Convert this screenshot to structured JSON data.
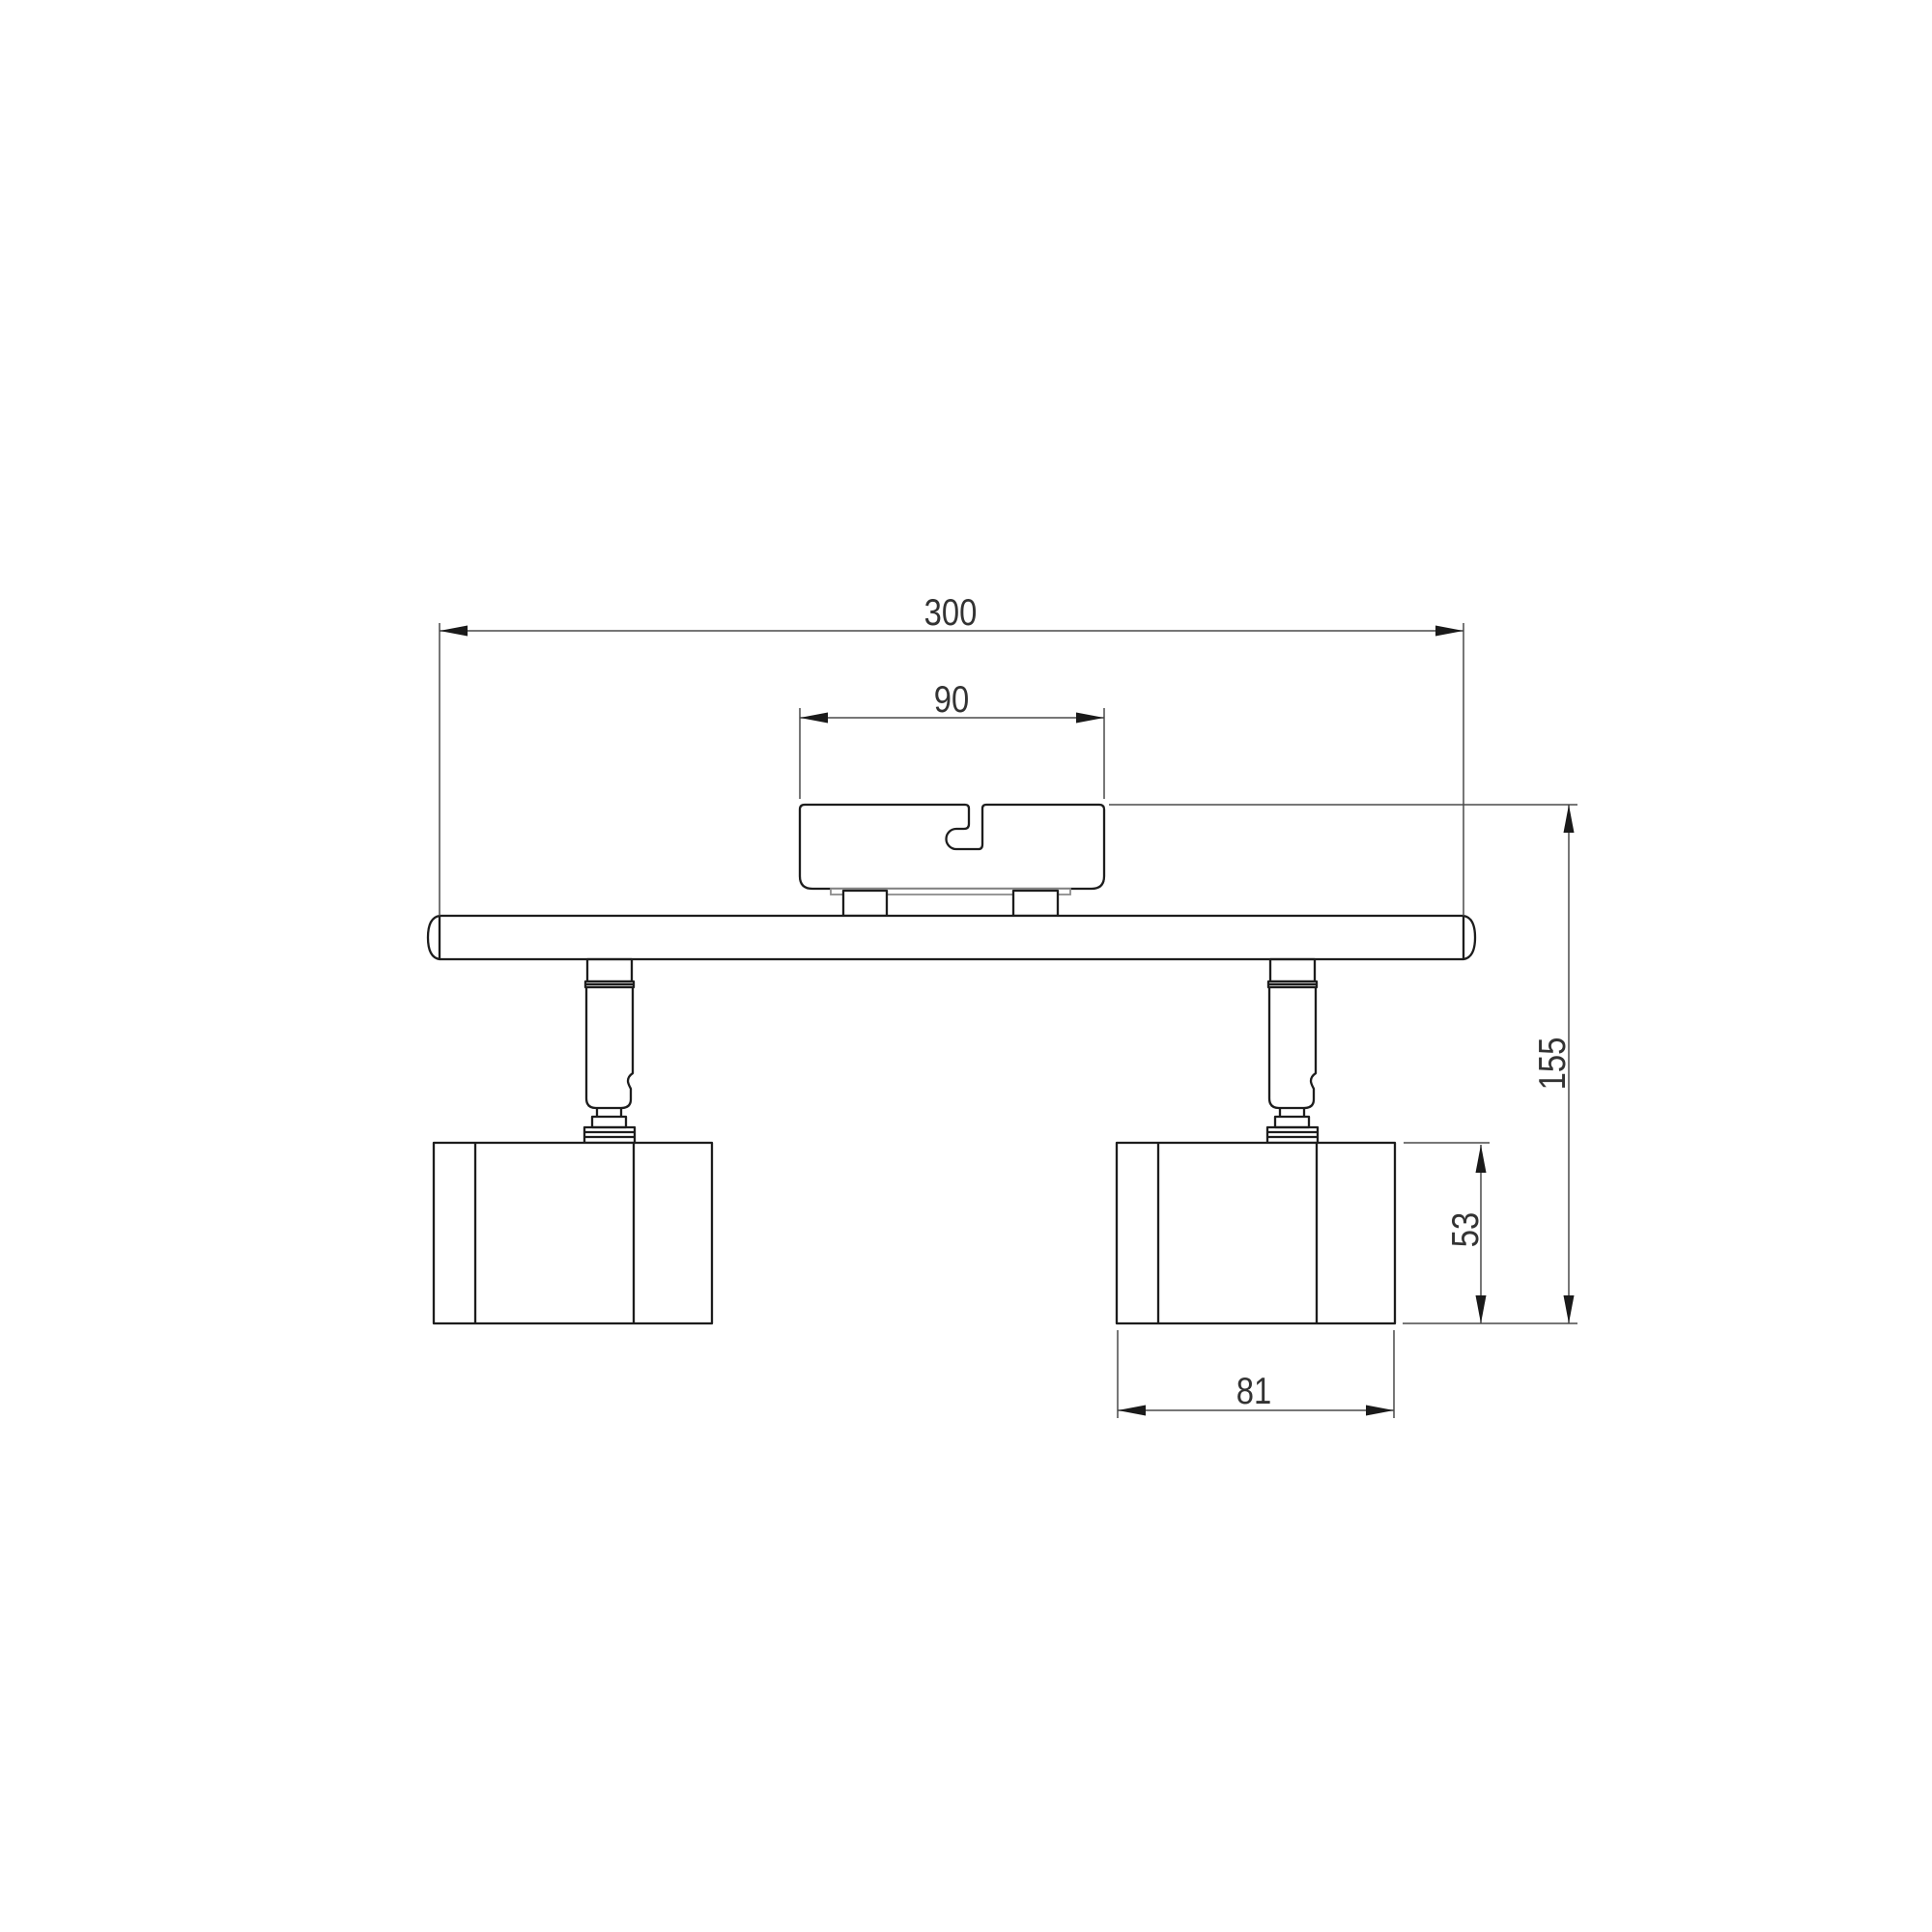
{
  "drawing": {
    "subject": "Two-head ceiling spotlight fixture, dimensioned front elevation",
    "style": "monochrome CAD line drawing",
    "background_color": "#ffffff",
    "object_line_color": "#1d1d1d",
    "dimension_line_color": "#4a4a4a",
    "text_color": "#333333"
  },
  "dimensions": {
    "overall_width": "300",
    "canopy_width": "90",
    "overall_height": "155",
    "head_height": "53",
    "head_width": "81"
  }
}
